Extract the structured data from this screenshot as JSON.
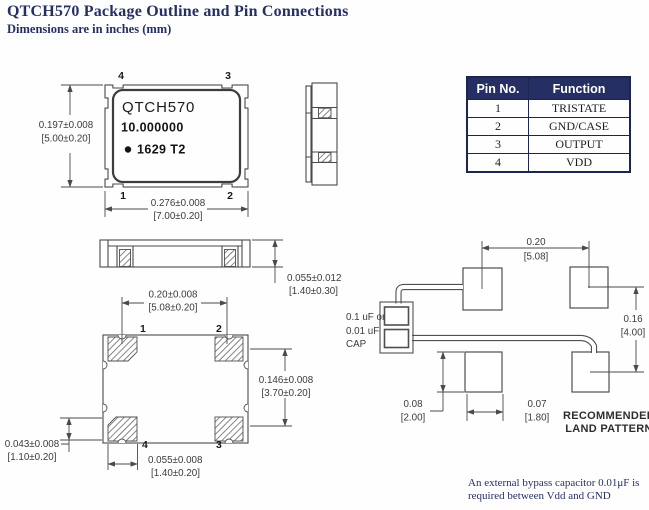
{
  "header": {
    "title": "QTCH570 Package Outline and Pin Connections",
    "subtitle": "Dimensions are in inches (mm)"
  },
  "pin_table": {
    "col_pin": "Pin No.",
    "col_function": "Function",
    "rows": [
      {
        "pin": "1",
        "function": "TRISTATE"
      },
      {
        "pin": "2",
        "function": "GND/CASE"
      },
      {
        "pin": "3",
        "function": "OUTPUT"
      },
      {
        "pin": "4",
        "function": "VDD"
      }
    ]
  },
  "top_view": {
    "marking": {
      "line1": "QTCH570",
      "line2": "10.000000",
      "line3": "1629  T2"
    },
    "pins": {
      "top_left": "4",
      "top_right": "3",
      "bottom_left": "1",
      "bottom_right": "2"
    },
    "dim_height": {
      "in": "0.197±0.008",
      "mm": "[5.00±0.20]"
    },
    "dim_width": {
      "in": "0.276±0.008",
      "mm": "[7.00±0.20]"
    }
  },
  "side_view": {
    "dim_thickness": {
      "in": "0.055±0.012",
      "mm": "[1.40±0.30]"
    }
  },
  "bottom_view": {
    "pins": {
      "top_left": "1",
      "top_right": "2",
      "bottom_left": "4",
      "bottom_right": "3"
    },
    "dim_pad_pitch": {
      "in": "0.20±0.008",
      "mm": "[5.08±0.20]"
    },
    "dim_body_height": {
      "in": "0.146±0.008",
      "mm": "[3.70±0.20]"
    },
    "dim_pad_height": {
      "in": "0.043±0.008",
      "mm": "[1.10±0.20]"
    },
    "dim_pad_width": {
      "in": "0.055±0.008",
      "mm": "[1.40±0.20]"
    }
  },
  "land_pattern": {
    "label": {
      "line1": "RECOMMENDED",
      "line2": "LAND PATTERN"
    },
    "cap_label": {
      "line1": "0.1 uF or",
      "line2": "0.01 uF",
      "line3": "CAP"
    },
    "dim_pad_pitch": {
      "in": "0.20",
      "mm": "[5.08]"
    },
    "dim_row_pitch": {
      "in": "0.16",
      "mm": "[4.00]"
    },
    "dim_pad_height": {
      "in": "0.08",
      "mm": "[2.00]"
    },
    "dim_pad_width": {
      "in": "0.07",
      "mm": "[1.80]"
    }
  },
  "note": {
    "line1": "An external bypass capacitor 0.01μF is",
    "line2": "required between Vdd and GND"
  },
  "colors": {
    "accent_navy": "#262f63",
    "line_gray": "#4a4a4a"
  }
}
